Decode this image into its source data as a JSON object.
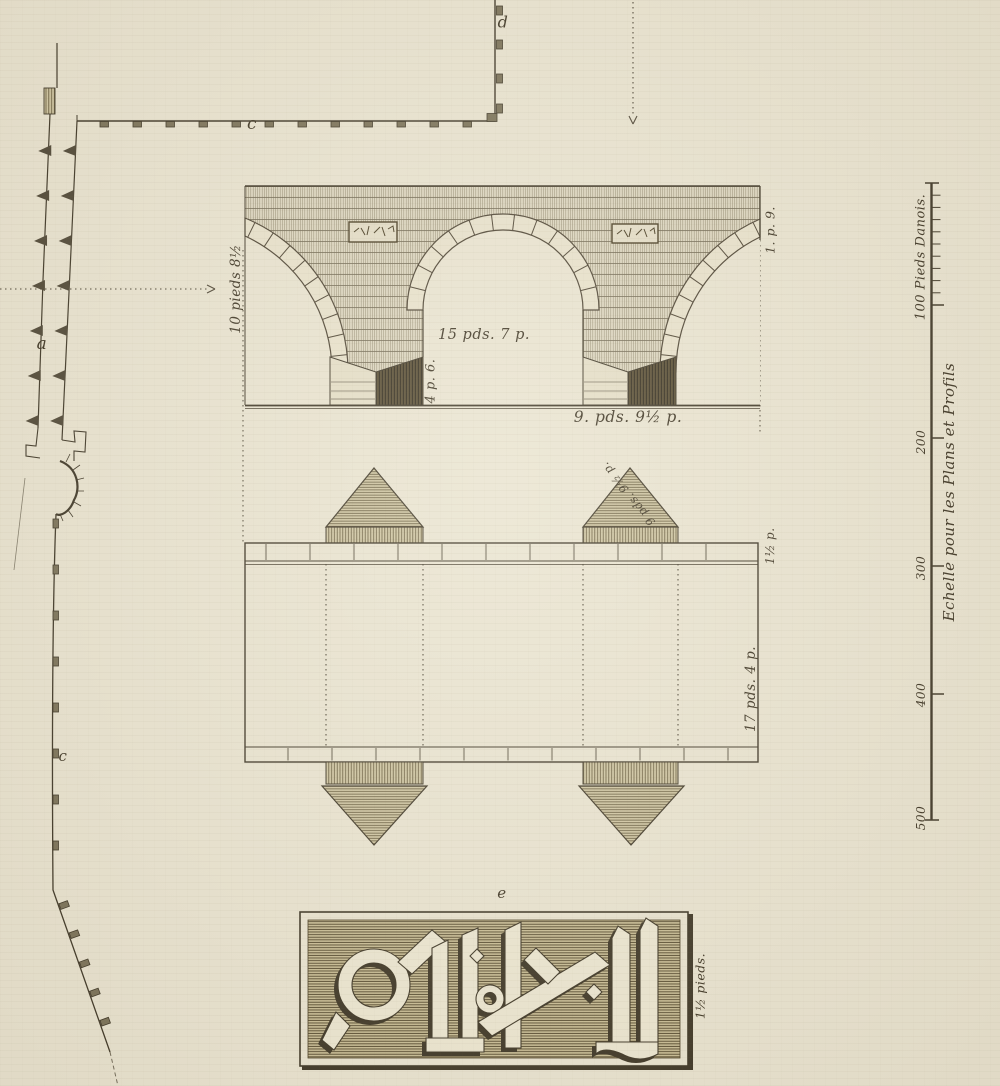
{
  "plate": {
    "description_colors": {
      "paper": "#e9e3d0",
      "ink": "#3e3626",
      "hatch": "#584c2e"
    }
  },
  "wall_plan": {
    "label_a": "a",
    "label_c_upper": "c",
    "label_c_lower": "c",
    "label_d": "d"
  },
  "elevation": {
    "height_label": "10 pieds 8½",
    "span_label": "15 pds. 7 p.",
    "pier_base_label": "4 p. 6.",
    "pier_width_label": "9. pds. 9½ p.",
    "parapet_label": "1. p. 9."
  },
  "plan": {
    "cutwater_label": "9 pds. 9½ p.",
    "deck_edge_label": "1½ p.",
    "width_label": "17 pds. 4 p."
  },
  "inscription": {
    "label_e": "e",
    "height_label": "1½ pieds."
  },
  "scale_bar": {
    "first_label": "100 Pieds Danois.",
    "ticks": [
      "200",
      "300",
      "400",
      "500"
    ],
    "title": "Echelle pour les Plans et Profils"
  }
}
